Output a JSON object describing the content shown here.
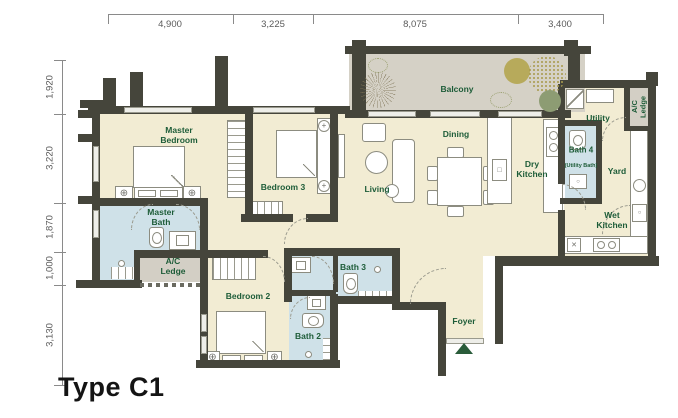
{
  "plan": {
    "title": "Type C1"
  },
  "dimensions": {
    "top": [
      "4,900",
      "3,225",
      "8,075",
      "3,400"
    ],
    "left": [
      "1,920",
      "3,220",
      "1,870",
      "1,000",
      "3,130"
    ]
  },
  "rooms": {
    "master_bedroom": {
      "label": "Master Bedroom"
    },
    "bedroom_2": {
      "label": "Bedroom 2"
    },
    "bedroom_3": {
      "label": "Bedroom 3"
    },
    "master_bath": {
      "label": "Master Bath"
    },
    "bath_2": {
      "label": "Bath 2"
    },
    "bath_3": {
      "label": "Bath 3"
    },
    "bath_4": {
      "label": "Bath 4",
      "sublabel": "(Utility Bath)"
    },
    "living": {
      "label": "Living"
    },
    "dining": {
      "label": "Dining"
    },
    "dry_kitchen": {
      "label": "Dry Kitchen"
    },
    "wet_kitchen": {
      "label": "Wet Kitchen"
    },
    "balcony": {
      "label": "Balcony"
    },
    "utility": {
      "label": "Utility"
    },
    "yard": {
      "label": "Yard"
    },
    "foyer": {
      "label": "Foyer"
    },
    "ac_ledge_left": {
      "label": "A/C Ledge"
    },
    "ac_ledge_right": {
      "label": "A/C Ledge"
    }
  },
  "colors": {
    "wall": "#45453b",
    "room_fill": "#f2ecd3",
    "bath_fill": "#cfe1e8",
    "balcony_fill": "#d5d1c6",
    "ledge_fill": "#d3cfc5",
    "room_label": "#1d5c38",
    "entry_arrow": "#2a5c3a",
    "dimension_text": "#5a5a5a"
  }
}
